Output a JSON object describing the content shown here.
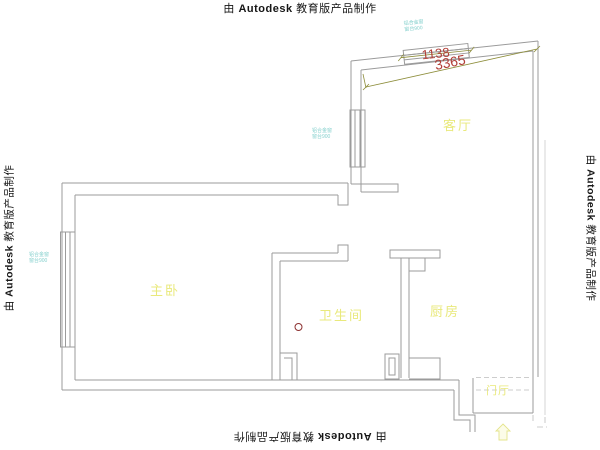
{
  "watermark": {
    "prefix": "由",
    "brand": "Autodesk",
    "suffix": "教育版产品制作"
  },
  "rooms": {
    "living_room": "客厅",
    "master_bedroom": "主卧",
    "bathroom": "卫生间",
    "kitchen": "厨房",
    "entry_hall": "门厅"
  },
  "dimensions": {
    "window_width": "1138",
    "wall_length": "3365"
  },
  "window_tag": {
    "line1": "铝合金窗",
    "line2": "窗台900"
  },
  "colors": {
    "wall": "#9b9b9b",
    "room_label": "#e9e97c",
    "dim_text": "#b23f38",
    "dim_line": "#8e8e3c",
    "window_tag": "#85d0cd",
    "drain": "#8c3030",
    "watermark": "#161616",
    "dashed": "#bdbdbd",
    "arrow": "#e4e48c"
  }
}
